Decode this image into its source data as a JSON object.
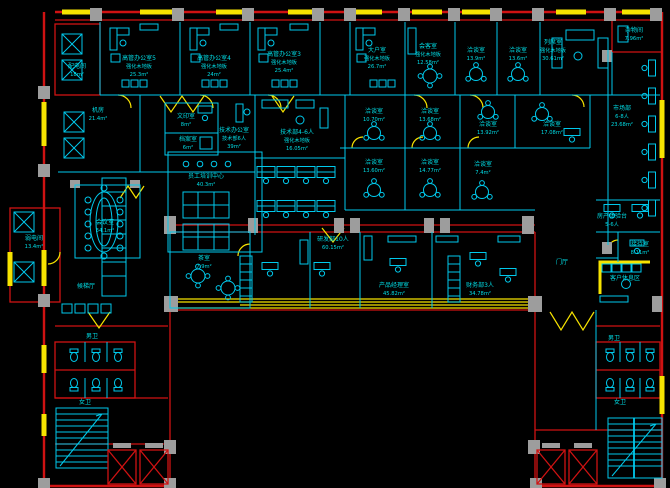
{
  "drawing": {
    "type": "CAD office floor plan",
    "colors": {
      "background": "#000000",
      "wall_red": "#cf1212",
      "partition_cyan": "#00c9ec",
      "window_yellow": "#f7e300",
      "column_gray": "#9d9d9d",
      "text_cyan": "#00dde6"
    }
  },
  "rooms": {
    "peidian": {
      "name": "配电间",
      "area": "18m²"
    },
    "exec5": {
      "name": "高管办公室5",
      "sub": "强化木地板",
      "area": "25.3m²"
    },
    "exec4": {
      "name": "高管办公室4",
      "sub": "强化木地板",
      "area": "24m²"
    },
    "exec3": {
      "name": "高管办公室3",
      "sub": "强化木地板",
      "area": "25.4m²"
    },
    "dahushi": {
      "name": "大户室",
      "sub": "强化木地板",
      "area": "26.7m²"
    },
    "huikeshi": {
      "name": "会客室",
      "sub": "强化木地板",
      "area": "12.58m²"
    },
    "qt_top1": {
      "name": "洽谈室",
      "area": "13.9m²"
    },
    "qt_top2": {
      "name": "洽谈室",
      "area": "13.6m²"
    },
    "liexishi": {
      "name": "列席室",
      "sub": "强化木地板",
      "area": "30.61m²"
    },
    "zawujian": {
      "name": "杂物间",
      "area": "7.96m²"
    },
    "shichangbu": {
      "name": "市场部",
      "sub": "6-8人",
      "area": "23.68m²"
    },
    "jifang": {
      "name": "机房",
      "area": "21.4m²"
    },
    "wenyinshi": {
      "name": "文印室",
      "area": "8m²"
    },
    "danganshi": {
      "name": "档案室",
      "area": "6m²"
    },
    "jishu_office": {
      "name": "技术办公室",
      "sub": "技术部6人",
      "area": "39m²"
    },
    "jishu46": {
      "name": "技术部4-6人",
      "sub": "强化木地板",
      "area": "16.05m²"
    },
    "qt_1070": {
      "name": "洽谈室",
      "area": "10.70m²"
    },
    "qt_1368": {
      "name": "洽谈室",
      "area": "13.68m²"
    },
    "qt_1392": {
      "name": "洽谈室",
      "area": "13.92m²"
    },
    "qt_1708": {
      "name": "洽谈室",
      "area": "17.08m²"
    },
    "qt_1360": {
      "name": "洽谈室",
      "area": "13.60m²"
    },
    "qt_1477": {
      "name": "洽谈室",
      "area": "14.77m²"
    },
    "qt_74": {
      "name": "洽谈室",
      "area": "7.4m²"
    },
    "peixun": {
      "name": "员工培训中心",
      "area": "40.3m²"
    },
    "chashi": {
      "name": "茶室",
      "area": "7.9m²"
    },
    "yanfabu": {
      "name": "研发部10人",
      "area": "60.15m²"
    },
    "chanpin": {
      "name": "产品经理室",
      "area": "45.82m²"
    },
    "caiwu": {
      "name": "财务部3人",
      "area": "34.78m²"
    },
    "huiyishi": {
      "name": "会议室",
      "area": "34.1m²"
    },
    "ruodian": {
      "name": "弱电间",
      "area": "13.4m²"
    },
    "houtiting": {
      "name": "候梯厅"
    },
    "menting": {
      "name": "门厅"
    },
    "fangchan": {
      "name": "房产体验台",
      "sub": "5-6人"
    },
    "jiedaishi": {
      "name": "接待室",
      "area": "8.11m²"
    },
    "kehu": {
      "name": "客户休息区"
    },
    "nanwei_left": {
      "name": "男卫"
    },
    "nvwei_left": {
      "name": "女卫"
    },
    "nanwei_right": {
      "name": "男卫"
    },
    "nvwei_right": {
      "name": "女卫"
    }
  }
}
